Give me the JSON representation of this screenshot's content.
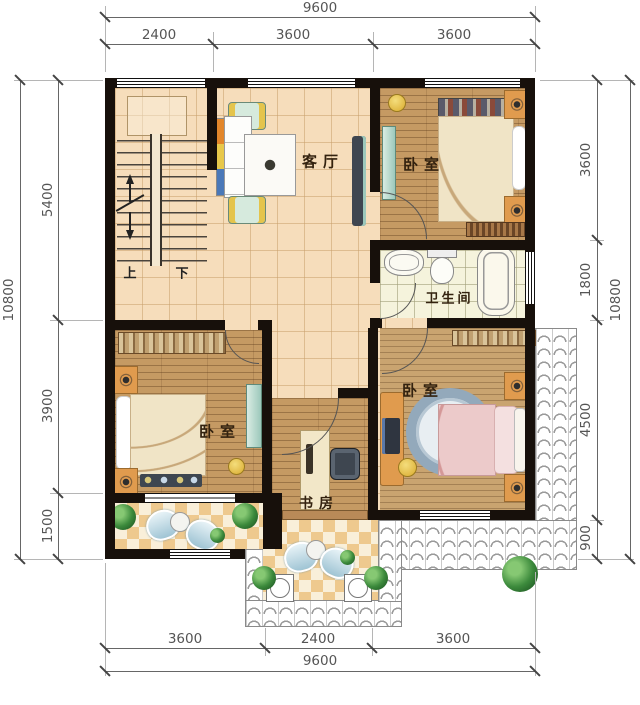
{
  "plan": {
    "rooms": {
      "living_room": "客厅",
      "bedroom_top_right": "卧室",
      "bedroom_bottom_left": "卧室",
      "bedroom_bottom_right": "卧室",
      "bathroom": "卫生间",
      "study": "书房",
      "stair_up": "上",
      "stair_down": "下"
    }
  },
  "dimensions": {
    "top": {
      "overall": "9600",
      "segments": [
        "2400",
        "3600",
        "3600"
      ]
    },
    "bottom": {
      "overall": "9600",
      "segments": [
        "3600",
        "2400",
        "3600"
      ]
    },
    "left": {
      "overall": "10800",
      "segments": [
        "5400",
        "3900",
        "1500"
      ]
    },
    "right": {
      "overall": "10800",
      "segments": [
        "3600",
        "1800",
        "4500",
        "900"
      ]
    }
  },
  "colors": {
    "wall": "#17100b",
    "tile_floor": "#f6ddbb",
    "wood_floor": "#c59a63",
    "bath_tile": "#f5f3dc",
    "checker_tan": "#eec98e",
    "accent_orange": "#e09b4e",
    "accent_teal": "#9cc8bb",
    "bed_pink": "#eccaca",
    "plant_green": "#2e7d32",
    "dimension_text": "#555555"
  }
}
